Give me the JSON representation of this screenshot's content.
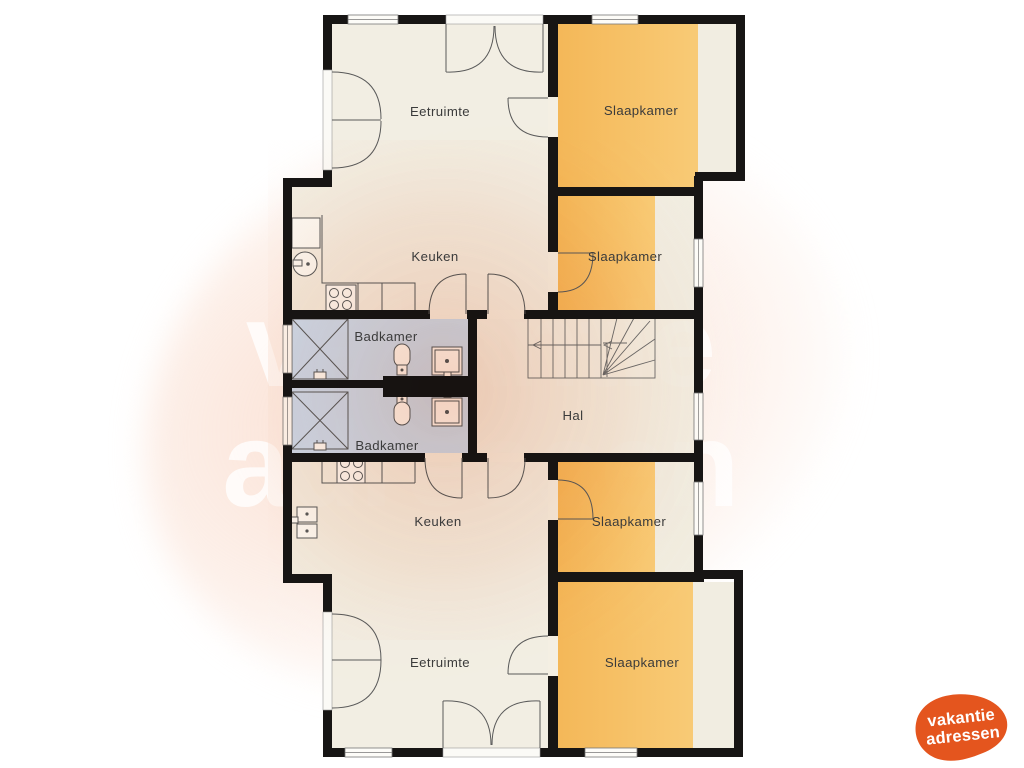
{
  "page": {
    "background_color": "#ffffff"
  },
  "watermark": {
    "line1": "vakantie",
    "line2": "adressen",
    "color": "#ffffff"
  },
  "logo": {
    "line1": "vakantie",
    "line2": "adressen",
    "blob_color": "#e4551e",
    "text_color": "#ffffff"
  },
  "floorplan": {
    "wall_color": "#171514",
    "room_fills": {
      "living_beige": "#f0ecdf",
      "bedroom_orange": "#f5ba55",
      "bathroom_blue": "#c8daf0",
      "tint_peach": "#f6d0be"
    },
    "rooms": [
      {
        "id": "eetruimte-top",
        "label": "Eetruimte"
      },
      {
        "id": "slaapkamer-top-1",
        "label": "Slaapkamer"
      },
      {
        "id": "keuken-top",
        "label": "Keuken"
      },
      {
        "id": "slaapkamer-top-2",
        "label": "Slaapkamer"
      },
      {
        "id": "badkamer-top",
        "label": "Badkamer"
      },
      {
        "id": "badkamer-bottom",
        "label": "Badkamer"
      },
      {
        "id": "hal",
        "label": "Hal"
      },
      {
        "id": "keuken-bottom",
        "label": "Keuken"
      },
      {
        "id": "slaapkamer-bottom-1",
        "label": "Slaapkamer"
      },
      {
        "id": "eetruimte-bottom",
        "label": "Eetruimte"
      },
      {
        "id": "slaapkamer-bottom-2",
        "label": "Slaapkamer"
      }
    ]
  }
}
